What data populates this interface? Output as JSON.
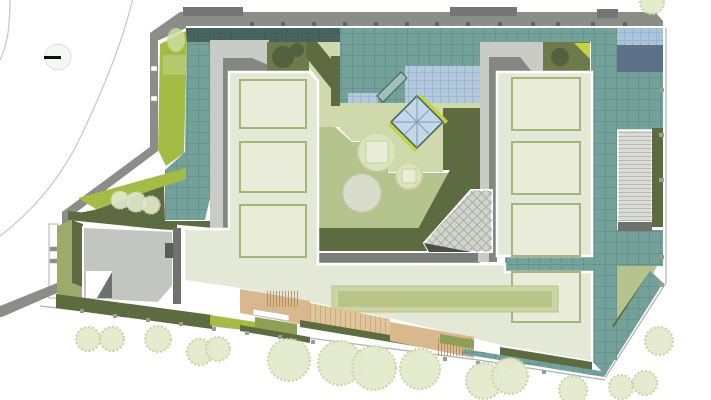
{
  "colors": {
    "background": "#ffffff",
    "road_line": "#c6c6c6",
    "boundary_line": "#b0b0b0",
    "wall_gray": "#8b8d89",
    "wall_block": "#747672",
    "wall_shadow": "#6f716d",
    "walk_light": "#c9cbc7",
    "walk_mid": "#858783",
    "walk_dark": "#5a5c58",
    "sage_roof": "#e4e8d6",
    "panel_line": "#a9b27b",
    "panel_fill": "#e9ecd9",
    "teal_glass": "#74a29a",
    "teal_dark": "#47645e",
    "teal_light": "#9fbfb7",
    "blue_glass": "#b3c9dc",
    "blue_pale": "#aac4dc",
    "blue_dark": "#5d7187",
    "diamond_blue": "#c3d7e9",
    "accent_green": "#c2d442",
    "bright_green": "#a4bc45",
    "bright_pale": "#b9cc7a",
    "olive_dark": "#5c6b40",
    "olive_mid": "#6d7a49",
    "olive_soft": "#8da055",
    "lawn_mid": "#b5c48e",
    "lawn_pale": "#cfd9ab",
    "planter_outer": "#cdd5a5",
    "planter_inner": "#b9c489",
    "tan_deck": "#d8b88c",
    "tan_light": "#e0c49a",
    "tree_fill": "#e3eacd",
    "tree_edge": "#c9d6a6",
    "tree_court": "#dce5ba",
    "tree_dark": "#4f5e3c",
    "tree_soft": "#ccdc9e",
    "court_circle": "#d9dcca",
    "court_gray": "#c3c5c1",
    "court_band": "#7b7d79",
    "green_ground": "#9cab6c",
    "hatch_fill": "#d2d4ce",
    "hatch_shadow": "#4b4d49",
    "terrace": "#dadbd7",
    "tick_dark": "#63655f",
    "tick_light": "#9a9c96",
    "white": "#ffffff",
    "symbol_black": "#111111"
  },
  "trees": {
    "street": [
      {
        "x": 88,
        "y": 339,
        "r": 12
      },
      {
        "x": 112,
        "y": 339,
        "r": 12
      },
      {
        "x": 158,
        "y": 339,
        "r": 13
      },
      {
        "x": 200,
        "y": 352,
        "r": 13
      },
      {
        "x": 218,
        "y": 349,
        "r": 12
      },
      {
        "x": 289,
        "y": 360,
        "r": 21
      },
      {
        "x": 340,
        "y": 363,
        "r": 22
      },
      {
        "x": 374,
        "y": 368,
        "r": 22
      },
      {
        "x": 420,
        "y": 369,
        "r": 20
      },
      {
        "x": 484,
        "y": 381,
        "r": 18
      },
      {
        "x": 510,
        "y": 376,
        "r": 18
      },
      {
        "x": 573,
        "y": 390,
        "r": 14
      },
      {
        "x": 621,
        "y": 387,
        "r": 12
      },
      {
        "x": 645,
        "y": 383,
        "r": 12
      },
      {
        "x": 659,
        "y": 341,
        "r": 14
      },
      {
        "x": 652,
        "y": 2,
        "r": 12
      }
    ],
    "bushes": [
      {
        "x": 120,
        "y": 200,
        "r": 9
      },
      {
        "x": 136,
        "y": 202,
        "r": 10
      },
      {
        "x": 151,
        "y": 205,
        "r": 9
      }
    ],
    "courtyard": [
      {
        "x": 377,
        "y": 152,
        "r": 19,
        "sq": {
          "x": 366,
          "y": 141,
          "s": 22
        }
      },
      {
        "x": 409,
        "y": 176,
        "r": 13,
        "sq": {
          "x": 402,
          "y": 169,
          "s": 14
        }
      }
    ],
    "dark": [
      {
        "x": 283,
        "y": 57,
        "r": 11
      },
      {
        "x": 297,
        "y": 50,
        "r": 7
      },
      {
        "x": 560,
        "y": 57,
        "r": 9
      }
    ]
  },
  "panels": {
    "left": [
      {
        "x": 240,
        "y": 80,
        "w": 66,
        "h": 48
      },
      {
        "x": 240,
        "y": 142,
        "w": 66,
        "h": 50
      },
      {
        "x": 240,
        "y": 205,
        "w": 66,
        "h": 52
      }
    ],
    "right": [
      {
        "x": 512,
        "y": 78,
        "w": 68,
        "h": 52
      },
      {
        "x": 512,
        "y": 142,
        "w": 68,
        "h": 52
      },
      {
        "x": 512,
        "y": 204,
        "w": 68,
        "h": 52
      },
      {
        "x": 512,
        "y": 272,
        "w": 68,
        "h": 50
      }
    ]
  },
  "planter": {
    "outer": {
      "x": 332,
      "y": 286,
      "w": 226,
      "h": 26
    },
    "inner": {
      "x": 338,
      "y": 291,
      "w": 214,
      "h": 16
    }
  },
  "ticks": {
    "parapet_x": [
      252,
      283,
      314,
      345,
      376,
      407,
      437,
      468,
      500,
      533,
      558,
      593,
      625
    ],
    "right_y": [
      88,
      133,
      178,
      255,
      283
    ],
    "bottom": [
      [
        82,
        311
      ],
      [
        115,
        316
      ],
      [
        148,
        320
      ],
      [
        181,
        324
      ],
      [
        214,
        329
      ],
      [
        247,
        333
      ],
      [
        280,
        337
      ],
      [
        313,
        342
      ],
      [
        346,
        346
      ],
      [
        379,
        350
      ],
      [
        412,
        355
      ],
      [
        445,
        359
      ],
      [
        478,
        363
      ],
      [
        511,
        368
      ],
      [
        544,
        372
      ]
    ],
    "wall": [
      {
        "x": 151,
        "y": 66,
        "w": 6,
        "h": 5,
        "f": "white"
      },
      {
        "x": 151,
        "y": 96,
        "w": 6,
        "h": 5,
        "f": "white"
      },
      {
        "x": 50,
        "y": 247,
        "w": 7,
        "h": 4,
        "f": "wall_gray"
      },
      {
        "x": 50,
        "y": 259,
        "w": 7,
        "h": 4,
        "f": "wall_gray"
      }
    ]
  },
  "survey_symbol": {
    "cx": 58,
    "cy": 57,
    "r": 13,
    "dash": {
      "x": 44,
      "y": 56,
      "w": 17,
      "h": 3
    }
  }
}
